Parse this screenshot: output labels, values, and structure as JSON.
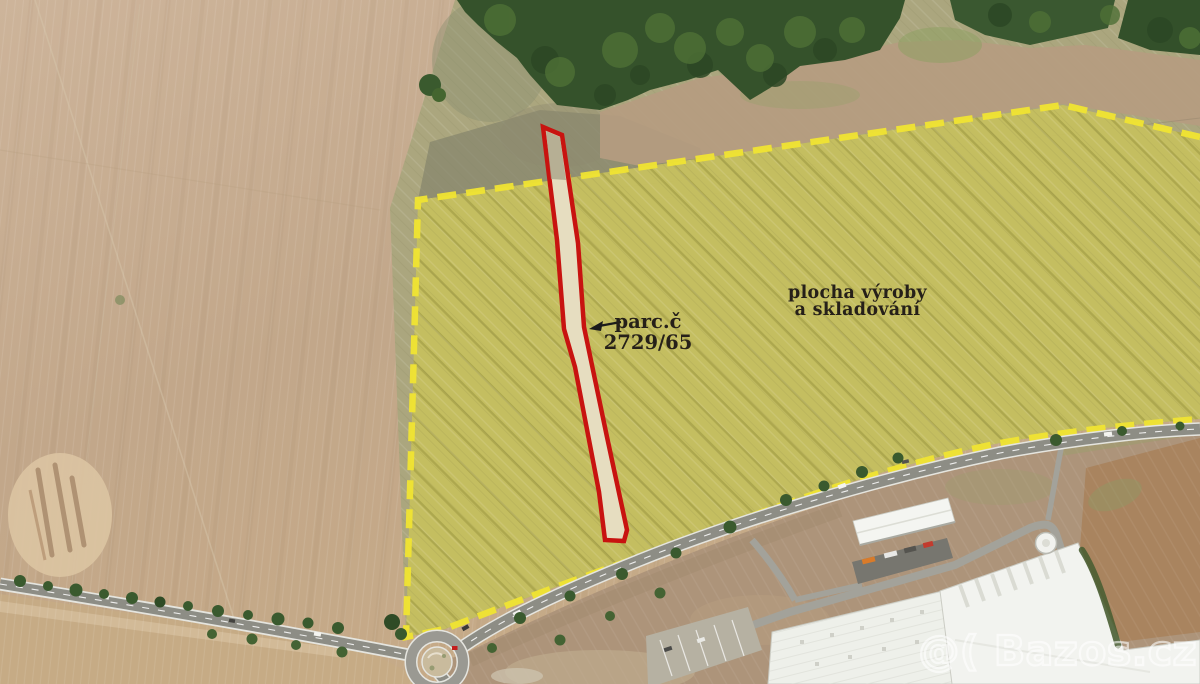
{
  "map": {
    "parcel": {
      "label_line1": "parc.č",
      "label_line2": "2729/65"
    },
    "zone": {
      "label_line1": "plocha výroby",
      "label_line2": "a skladování"
    },
    "watermark": "@( Bazos.cz",
    "colors": {
      "zone_fill": "#c6c05e",
      "zone_hatch": "#9e9a43",
      "zone_border_dash": "#f0e432",
      "parcel_border": "#c81310",
      "parcel_fill": "#e6ddc0",
      "label_text": "#262019",
      "watermark_stroke": "#ffffff",
      "forest": "#35522b",
      "plowed_field": "#c3a98d",
      "road": "#8d8d85"
    }
  }
}
